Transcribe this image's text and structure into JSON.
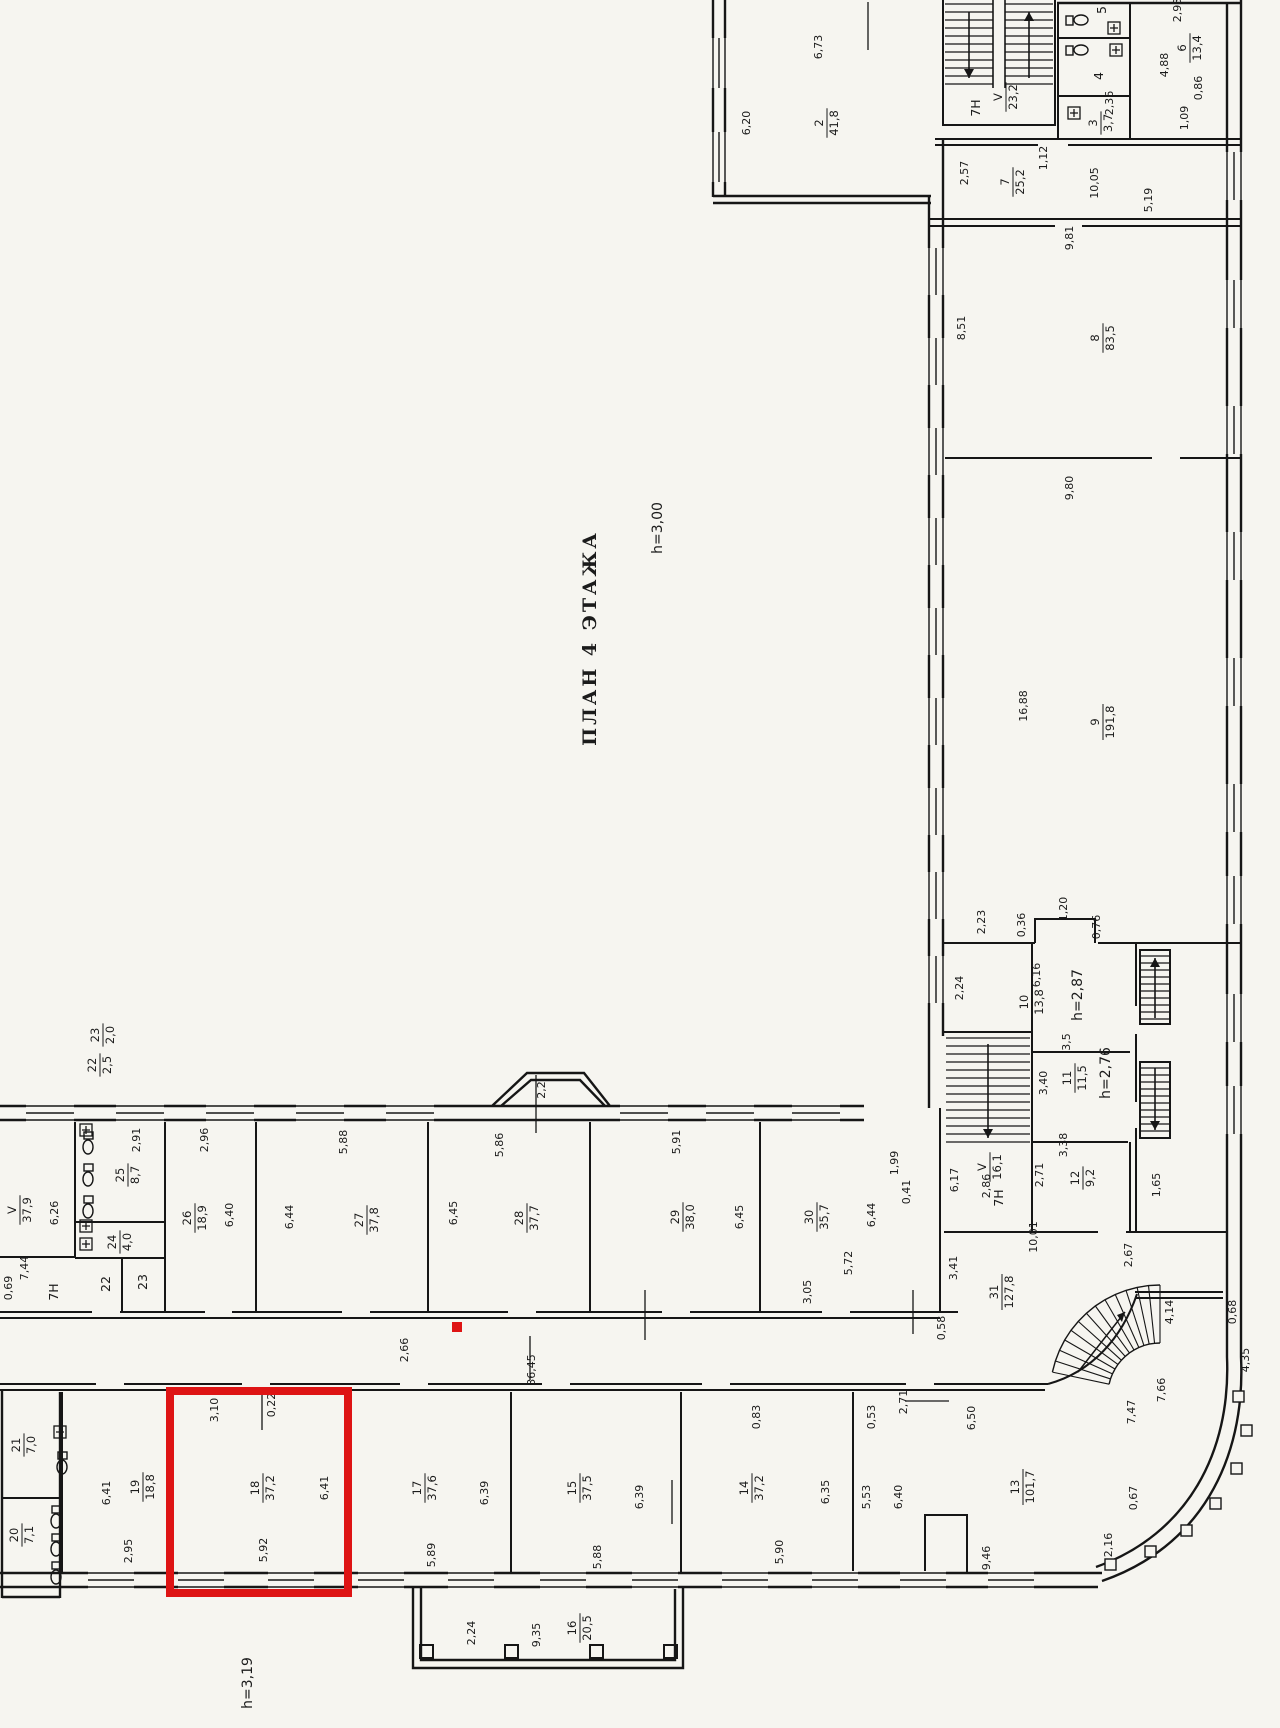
{
  "document": {
    "type": "scanned architectural floor plan",
    "title": "ПЛАН 4 ЭТАЖА",
    "floor_height_note": "h=3,00",
    "language": "ru"
  },
  "annotations": {
    "highlight_color": "#de1414",
    "highlighted_room": {
      "number": "18",
      "area": "37,2"
    },
    "highlight_rect": {
      "x": 170,
      "y": 1391,
      "w": 178,
      "h": 202
    },
    "highlight_marker": {
      "x": 452,
      "y": 1322,
      "s": 10
    }
  },
  "height_notes": [
    "h=3,00",
    "h=3,19",
    "h=2,87",
    "h=2,76"
  ],
  "rooms": [
    {
      "number": "2",
      "area": "41,8"
    },
    {
      "number": "3",
      "area": "3,7"
    },
    {
      "number": "4",
      "area": ""
    },
    {
      "number": "5",
      "area": ""
    },
    {
      "number": "6",
      "area": "13,4"
    },
    {
      "number": "7",
      "area": "25,2"
    },
    {
      "number": "8",
      "area": "83,5"
    },
    {
      "number": "9",
      "area": "191,8"
    },
    {
      "number": "10",
      "area": "13,8",
      "height": "h=2,87"
    },
    {
      "number": "11",
      "area": "11,5",
      "height": "h=2,76"
    },
    {
      "number": "12",
      "area": "9,2"
    },
    {
      "number": "13",
      "area": "101,7"
    },
    {
      "number": "14",
      "area": "37,2"
    },
    {
      "number": "15",
      "area": "37,5"
    },
    {
      "number": "16",
      "area": "20,5"
    },
    {
      "number": "17",
      "area": "37,6"
    },
    {
      "number": "18",
      "area": "37,2",
      "highlighted": true
    },
    {
      "number": "19",
      "area": "18,8"
    },
    {
      "number": "20",
      "area": "7,1"
    },
    {
      "number": "21",
      "area": "7,0"
    },
    {
      "number": "22",
      "area": "2,5"
    },
    {
      "number": "23",
      "area": "2,0"
    },
    {
      "number": "24",
      "area": "4,0"
    },
    {
      "number": "25",
      "area": "8,7"
    },
    {
      "number": "26",
      "area": "18,9"
    },
    {
      "number": "27",
      "area": "37,8"
    },
    {
      "number": "28",
      "area": "37,7"
    },
    {
      "number": "29",
      "area": "38,0"
    },
    {
      "number": "30",
      "area": "35,7"
    },
    {
      "number": "31",
      "area": "127,8"
    },
    {
      "number": "V",
      "area": "37,9"
    },
    {
      "number": "V",
      "area": "23,2"
    },
    {
      "number": "V",
      "area": "16,1"
    }
  ],
  "labels": [
    {
      "k": "title",
      "t": "ПЛАН 4 ЭТАЖА",
      "x": 596,
      "y": 638
    },
    {
      "k": "note",
      "t": "h=3,00",
      "x": 662,
      "y": 528
    },
    {
      "k": "note",
      "t": "h=2,87",
      "x": 1082,
      "y": 995
    },
    {
      "k": "note",
      "t": "h=2,76",
      "x": 1110,
      "y": 1073
    },
    {
      "k": "note",
      "t": "h=3,19",
      "x": 252,
      "y": 1683
    },
    {
      "k": "room",
      "a": "2",
      "b": "41,8",
      "x": 827,
      "y": 123
    },
    {
      "k": "room",
      "a": "6",
      "b": "13,4",
      "x": 1190,
      "y": 48
    },
    {
      "k": "room",
      "a": "3",
      "b": "3,7",
      "x": 1101,
      "y": 123
    },
    {
      "k": "room",
      "a": "V",
      "b": "23,2",
      "x": 1006,
      "y": 97
    },
    {
      "k": "room",
      "a": "7",
      "b": "25,2",
      "x": 1013,
      "y": 182
    },
    {
      "k": "room",
      "a": "8",
      "b": "83,5",
      "x": 1103,
      "y": 338
    },
    {
      "k": "room",
      "a": "9",
      "b": "191,8",
      "x": 1103,
      "y": 722
    },
    {
      "k": "room",
      "a": "10",
      "b": "13,8",
      "x": 1032,
      "y": 1002
    },
    {
      "k": "room",
      "a": "11",
      "b": "11,5",
      "x": 1075,
      "y": 1078
    },
    {
      "k": "room",
      "a": "12",
      "b": "9,2",
      "x": 1083,
      "y": 1178
    },
    {
      "k": "room",
      "a": "V",
      "b": "16,1",
      "x": 990,
      "y": 1167
    },
    {
      "k": "room",
      "a": "23",
      "b": "2,0",
      "x": 103,
      "y": 1035
    },
    {
      "k": "room",
      "a": "22",
      "b": "2,5",
      "x": 100,
      "y": 1065
    },
    {
      "k": "room",
      "a": "V",
      "b": "37,9",
      "x": 20,
      "y": 1210
    },
    {
      "k": "room",
      "a": "25",
      "b": "8,7",
      "x": 128,
      "y": 1175
    },
    {
      "k": "room",
      "a": "24",
      "b": "4,0",
      "x": 120,
      "y": 1242
    },
    {
      "k": "room",
      "a": "26",
      "b": "18,9",
      "x": 195,
      "y": 1218
    },
    {
      "k": "room",
      "a": "27",
      "b": "37,8",
      "x": 367,
      "y": 1220
    },
    {
      "k": "room",
      "a": "28",
      "b": "37,7",
      "x": 527,
      "y": 1218
    },
    {
      "k": "room",
      "a": "29",
      "b": "38,0",
      "x": 683,
      "y": 1217
    },
    {
      "k": "room",
      "a": "30",
      "b": "35,7",
      "x": 817,
      "y": 1217
    },
    {
      "k": "room",
      "a": "31",
      "b": "127,8",
      "x": 1002,
      "y": 1292
    },
    {
      "k": "room",
      "a": "21",
      "b": "7,0",
      "x": 24,
      "y": 1445
    },
    {
      "k": "room",
      "a": "20",
      "b": "7,1",
      "x": 22,
      "y": 1535
    },
    {
      "k": "room",
      "a": "19",
      "b": "18,8",
      "x": 143,
      "y": 1487
    },
    {
      "k": "room",
      "a": "18",
      "b": "37,2",
      "x": 263,
      "y": 1488
    },
    {
      "k": "room",
      "a": "17",
      "b": "37,6",
      "x": 425,
      "y": 1488
    },
    {
      "k": "room",
      "a": "15",
      "b": "37,5",
      "x": 580,
      "y": 1488
    },
    {
      "k": "room",
      "a": "14",
      "b": "37,2",
      "x": 752,
      "y": 1488
    },
    {
      "k": "room",
      "a": "13",
      "b": "101,7",
      "x": 1023,
      "y": 1487
    },
    {
      "k": "room",
      "a": "16",
      "b": "20,5",
      "x": 580,
      "y": 1628
    },
    {
      "k": "tag",
      "t": "7H",
      "x": 980,
      "y": 108
    },
    {
      "k": "tag",
      "t": "7H",
      "x": 58,
      "y": 1292
    },
    {
      "k": "tag",
      "t": "7H",
      "x": 1003,
      "y": 1198
    },
    {
      "k": "tag",
      "t": "22",
      "x": 110,
      "y": 1284
    },
    {
      "k": "tag",
      "t": "23",
      "x": 147,
      "y": 1282
    },
    {
      "k": "tag",
      "t": "5",
      "x": 1106,
      "y": 10
    },
    {
      "k": "tag",
      "t": "4",
      "x": 1103,
      "y": 76
    },
    {
      "k": "dim",
      "t": "6,73",
      "x": 822,
      "y": 47
    },
    {
      "k": "dim",
      "t": "6,20",
      "x": 750,
      "y": 123
    },
    {
      "k": "dim",
      "t": "2,93",
      "x": 1181,
      "y": 10
    },
    {
      "k": "dim",
      "t": "4,88",
      "x": 1168,
      "y": 65
    },
    {
      "k": "dim",
      "t": "0,86",
      "x": 1202,
      "y": 88
    },
    {
      "k": "dim",
      "t": "1,09",
      "x": 1188,
      "y": 118
    },
    {
      "k": "dim",
      "t": "2,36",
      "x": 1113,
      "y": 103
    },
    {
      "k": "dim",
      "t": "2,57",
      "x": 968,
      "y": 173
    },
    {
      "k": "dim",
      "t": "1,12",
      "x": 1047,
      "y": 158
    },
    {
      "k": "dim",
      "t": "10,05",
      "x": 1098,
      "y": 183
    },
    {
      "k": "dim",
      "t": "5,19",
      "x": 1152,
      "y": 200
    },
    {
      "k": "dim",
      "t": "9,81",
      "x": 1073,
      "y": 238
    },
    {
      "k": "dim",
      "t": "8,51",
      "x": 965,
      "y": 328
    },
    {
      "k": "dim",
      "t": "9,80",
      "x": 1073,
      "y": 488
    },
    {
      "k": "dim",
      "t": "16,88",
      "x": 1027,
      "y": 706
    },
    {
      "k": "dim",
      "t": "2,23",
      "x": 985,
      "y": 922
    },
    {
      "k": "dim",
      "t": "0,36",
      "x": 1025,
      "y": 925
    },
    {
      "k": "dim",
      "t": "1,20",
      "x": 1067,
      "y": 909
    },
    {
      "k": "dim",
      "t": "0,76",
      "x": 1100,
      "y": 927
    },
    {
      "k": "dim",
      "t": "2,24",
      "x": 963,
      "y": 988
    },
    {
      "k": "dim",
      "t": "6,16",
      "x": 1040,
      "y": 975
    },
    {
      "k": "dim",
      "t": "3,40",
      "x": 1047,
      "y": 1083
    },
    {
      "k": "dim",
      "t": "3,5",
      "x": 1070,
      "y": 1042
    },
    {
      "k": "dim",
      "t": "3,38",
      "x": 1067,
      "y": 1145
    },
    {
      "k": "dim",
      "t": "2,71",
      "x": 1043,
      "y": 1175
    },
    {
      "k": "dim",
      "t": "1,65",
      "x": 1160,
      "y": 1185
    },
    {
      "k": "dim",
      "t": "2,86",
      "x": 990,
      "y": 1186
    },
    {
      "k": "dim",
      "t": "6,17",
      "x": 958,
      "y": 1180
    },
    {
      "k": "dim",
      "t": "1,99",
      "x": 898,
      "y": 1163
    },
    {
      "k": "dim",
      "t": "0,41",
      "x": 910,
      "y": 1192
    },
    {
      "k": "dim",
      "t": "6,26",
      "x": 58,
      "y": 1213
    },
    {
      "k": "dim",
      "t": "2,91",
      "x": 140,
      "y": 1140
    },
    {
      "k": "dim",
      "t": "2,96",
      "x": 208,
      "y": 1140
    },
    {
      "k": "dim",
      "t": "6,40",
      "x": 233,
      "y": 1215
    },
    {
      "k": "dim",
      "t": "6,44",
      "x": 293,
      "y": 1217
    },
    {
      "k": "dim",
      "t": "5,88",
      "x": 347,
      "y": 1142
    },
    {
      "k": "dim",
      "t": "6,45",
      "x": 457,
      "y": 1213
    },
    {
      "k": "dim",
      "t": "5,86",
      "x": 503,
      "y": 1145
    },
    {
      "k": "dim",
      "t": "2,2",
      "x": 545,
      "y": 1090
    },
    {
      "k": "dim",
      "t": "5,91",
      "x": 680,
      "y": 1142
    },
    {
      "k": "dim",
      "t": "6,45",
      "x": 743,
      "y": 1217
    },
    {
      "k": "dim",
      "t": "6,44",
      "x": 875,
      "y": 1215
    },
    {
      "k": "dim",
      "t": "7,44",
      "x": 28,
      "y": 1268
    },
    {
      "k": "dim",
      "t": "0,69",
      "x": 12,
      "y": 1288
    },
    {
      "k": "dim",
      "t": "2,66",
      "x": 408,
      "y": 1350
    },
    {
      "k": "dim",
      "t": "36,45",
      "x": 535,
      "y": 1370
    },
    {
      "k": "dim",
      "t": "3,05",
      "x": 811,
      "y": 1292
    },
    {
      "k": "dim",
      "t": "5,72",
      "x": 852,
      "y": 1263
    },
    {
      "k": "dim",
      "t": "3,41",
      "x": 957,
      "y": 1268
    },
    {
      "k": "dim",
      "t": "0,58",
      "x": 945,
      "y": 1328
    },
    {
      "k": "dim",
      "t": "10,01",
      "x": 1037,
      "y": 1237
    },
    {
      "k": "dim",
      "t": "2,67",
      "x": 1132,
      "y": 1255
    },
    {
      "k": "dim",
      "t": "4,14",
      "x": 1173,
      "y": 1312
    },
    {
      "k": "dim",
      "t": "0,68",
      "x": 1236,
      "y": 1312
    },
    {
      "k": "dim",
      "t": "4,35",
      "x": 1249,
      "y": 1360
    },
    {
      "k": "dim",
      "t": "7,66",
      "x": 1165,
      "y": 1390
    },
    {
      "k": "dim",
      "t": "7,47",
      "x": 1135,
      "y": 1412
    },
    {
      "k": "dim",
      "t": "2,71",
      "x": 907,
      "y": 1402
    },
    {
      "k": "dim",
      "t": "0,53",
      "x": 875,
      "y": 1417
    },
    {
      "k": "dim",
      "t": "6,50",
      "x": 975,
      "y": 1418
    },
    {
      "k": "dim",
      "t": "0,83",
      "x": 760,
      "y": 1417
    },
    {
      "k": "dim",
      "t": "6,41",
      "x": 110,
      "y": 1493
    },
    {
      "k": "dim",
      "t": "2,95",
      "x": 132,
      "y": 1551
    },
    {
      "k": "dim",
      "t": "3,10",
      "x": 218,
      "y": 1410
    },
    {
      "k": "dim",
      "t": "0,22",
      "x": 275,
      "y": 1405
    },
    {
      "k": "dim",
      "t": "6,41",
      "x": 328,
      "y": 1488
    },
    {
      "k": "dim",
      "t": "5,92",
      "x": 267,
      "y": 1550
    },
    {
      "k": "dim",
      "t": "6,39",
      "x": 488,
      "y": 1493
    },
    {
      "k": "dim",
      "t": "5,89",
      "x": 435,
      "y": 1555
    },
    {
      "k": "dim",
      "t": "6,39",
      "x": 643,
      "y": 1497
    },
    {
      "k": "dim",
      "t": "5,88",
      "x": 601,
      "y": 1557
    },
    {
      "k": "dim",
      "t": "6,35",
      "x": 829,
      "y": 1492
    },
    {
      "k": "dim",
      "t": "5,90",
      "x": 783,
      "y": 1552
    },
    {
      "k": "dim",
      "t": "5,53",
      "x": 870,
      "y": 1497
    },
    {
      "k": "dim",
      "t": "6,40",
      "x": 902,
      "y": 1497
    },
    {
      "k": "dim",
      "t": "9,46",
      "x": 990,
      "y": 1558
    },
    {
      "k": "dim",
      "t": "0,67",
      "x": 1137,
      "y": 1498
    },
    {
      "k": "dim",
      "t": "2,16",
      "x": 1112,
      "y": 1545
    },
    {
      "k": "dim",
      "t": "2,24",
      "x": 475,
      "y": 1633
    },
    {
      "k": "dim",
      "t": "9,35",
      "x": 540,
      "y": 1635
    }
  ]
}
